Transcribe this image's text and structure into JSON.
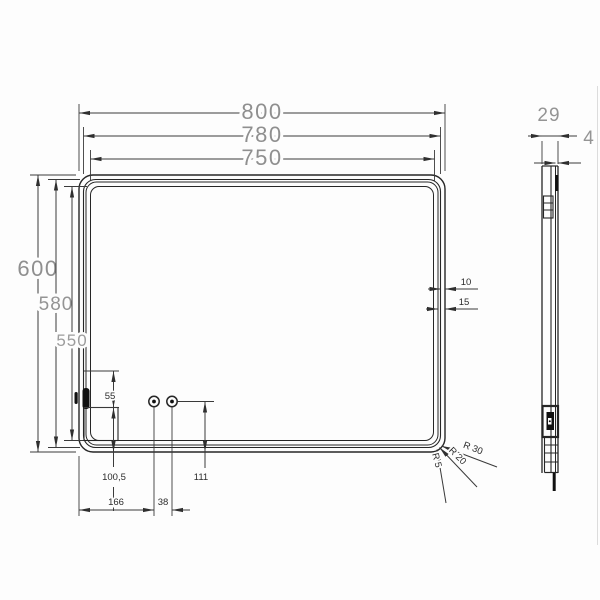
{
  "front_view": {
    "widths": {
      "outer": "800",
      "middle": "780",
      "inner": "750"
    },
    "heights": {
      "outer": "600",
      "middle": "580",
      "inner": "550"
    },
    "edge_offsets": {
      "first": "10",
      "second": "15"
    },
    "sensor_height": "55",
    "sensor_bottom_offset": "100,5",
    "holes_bottom_offset": "111",
    "hole_left_offset": "166",
    "hole_spacing": "38",
    "corner_radii": {
      "outer": "R 30",
      "middle": "R 20",
      "inner": "R 5"
    }
  },
  "side_view": {
    "depth": "29",
    "glass_thickness": "4"
  }
}
